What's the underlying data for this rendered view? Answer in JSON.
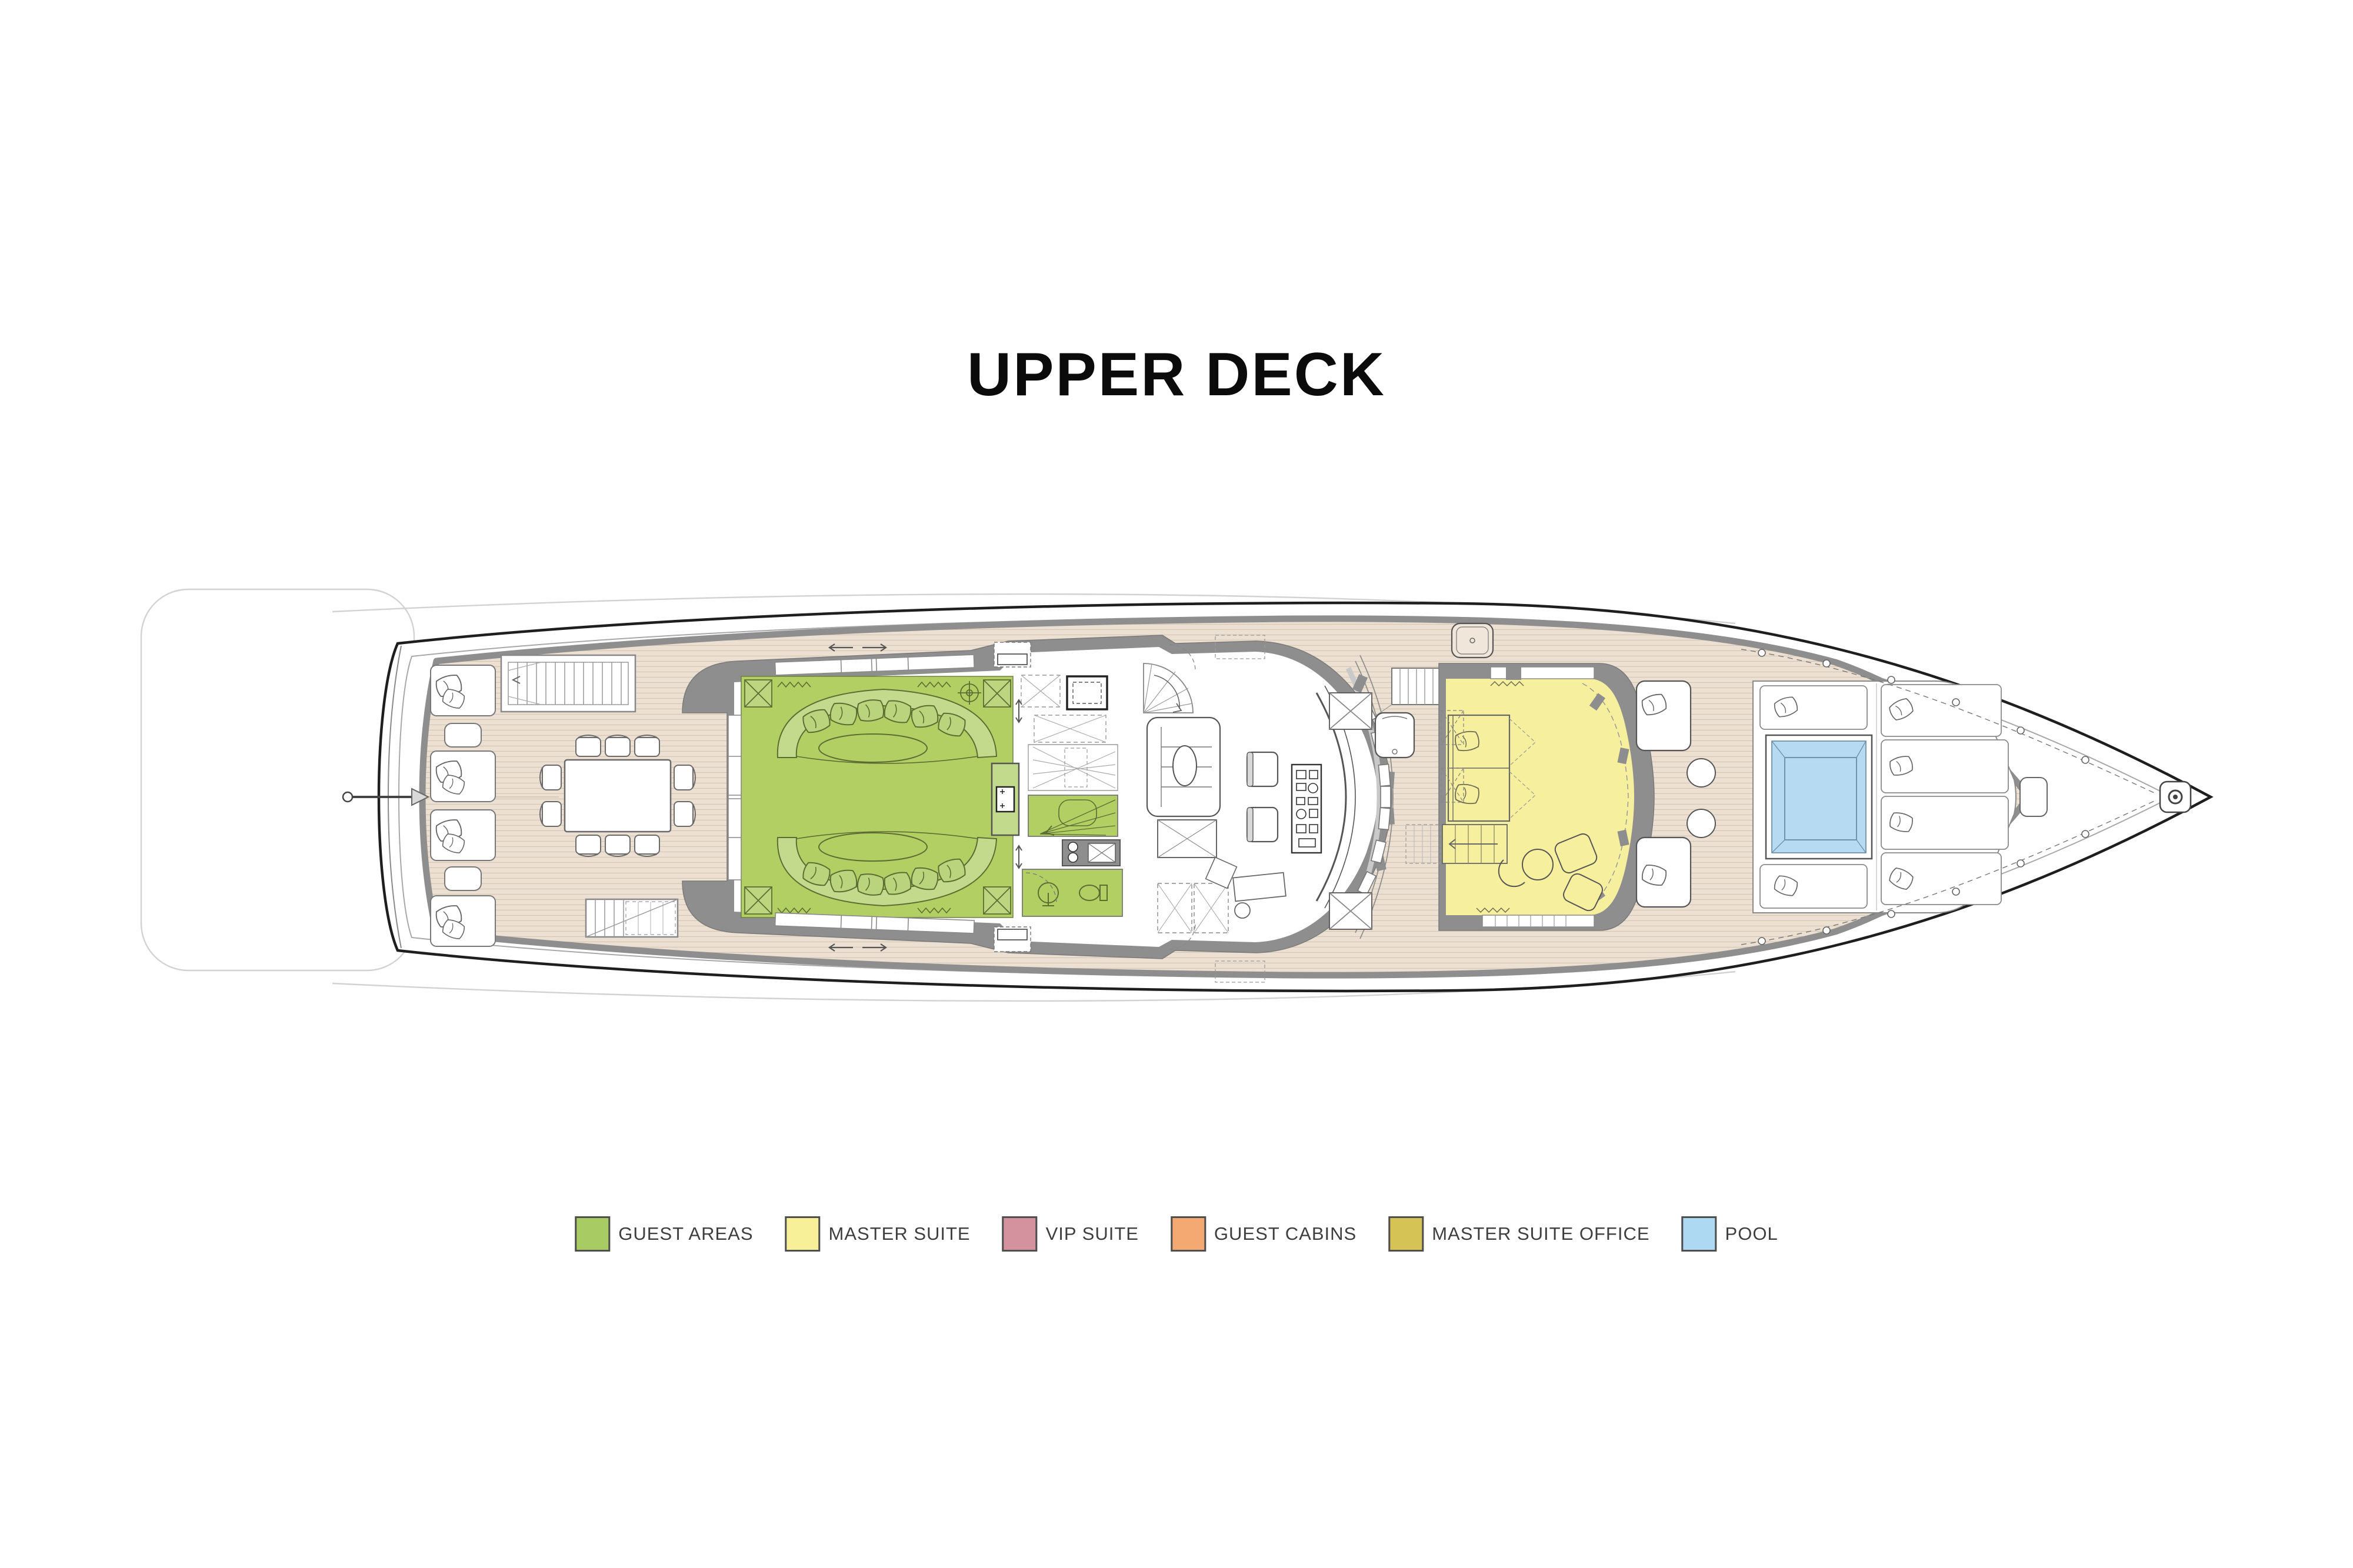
{
  "title": "UPPER DECK",
  "legend": {
    "items": [
      {
        "id": "guest-areas",
        "label": "GUEST AREAS",
        "color": "#a9cb64"
      },
      {
        "id": "master-suite",
        "label": "MASTER SUITE",
        "color": "#f7f099"
      },
      {
        "id": "vip-suite",
        "label": "VIP SUITE",
        "color": "#d3929e"
      },
      {
        "id": "guest-cabins",
        "label": "GUEST CABINS",
        "color": "#f3a971"
      },
      {
        "id": "master-suite-office",
        "label": "MASTER SUITE OFFICE",
        "color": "#d5c356"
      },
      {
        "id": "pool",
        "label": "POOL",
        "color": "#aed9f2"
      }
    ]
  },
  "rooms": {
    "sky_lounge": "#b2cf63",
    "master_suite": "#f6ef9e",
    "pool_water": "#b5daf1"
  }
}
